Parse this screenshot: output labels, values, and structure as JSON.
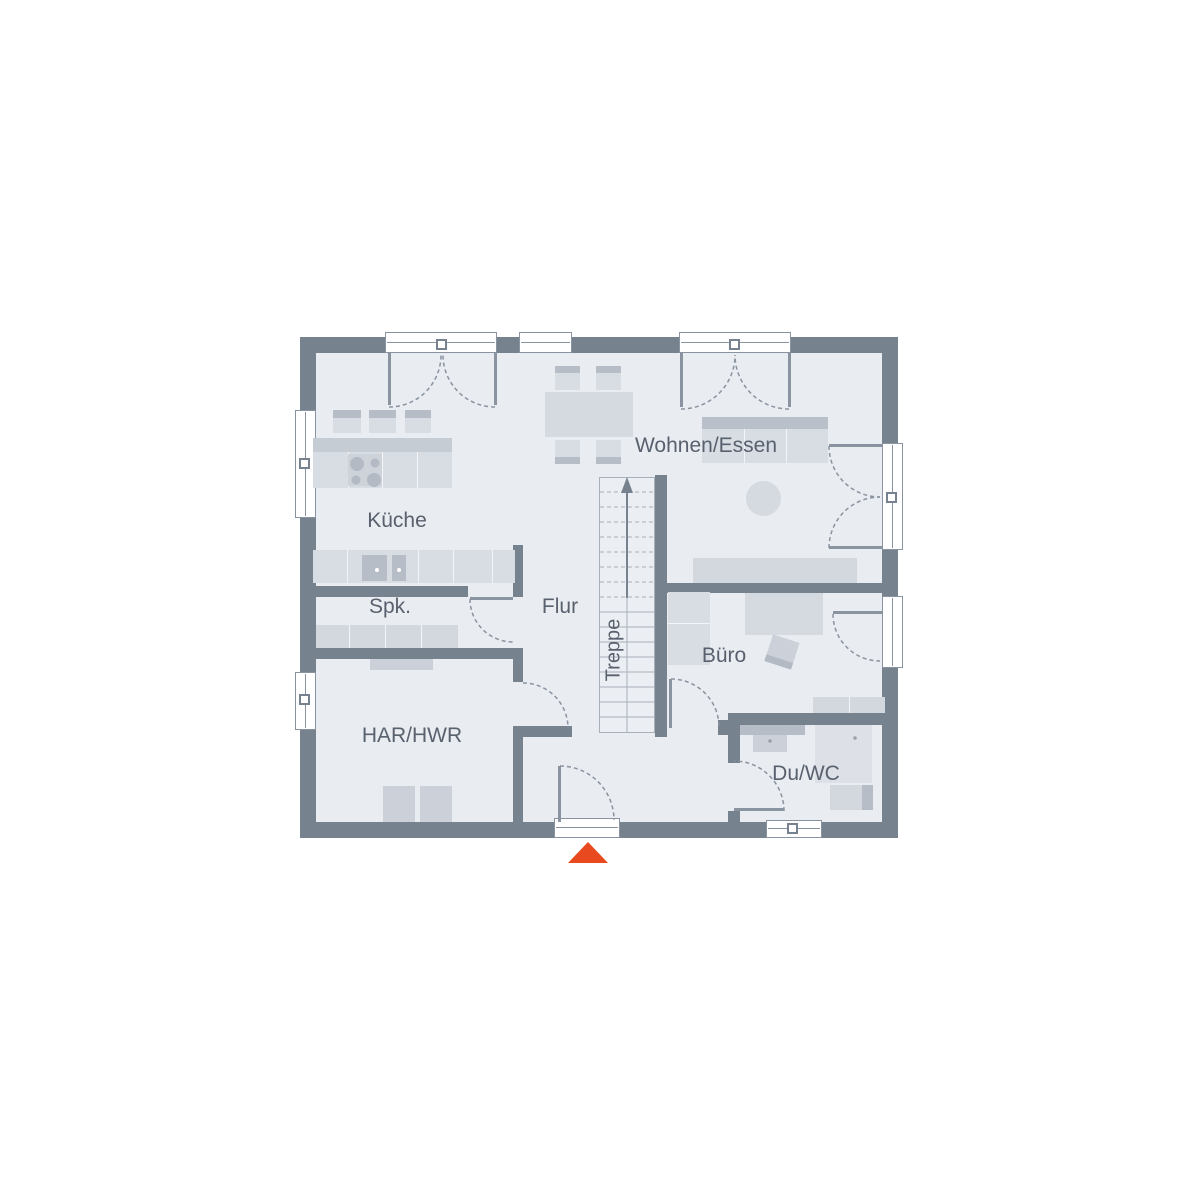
{
  "plan": {
    "rooms": {
      "kueche": "Küche",
      "spk": "Spk.",
      "flur": "Flur",
      "har_hwr": "HAR/HWR",
      "treppe": "Treppe",
      "wohnen_essen": "Wohnen/Essen",
      "buero": "Büro",
      "du_wc": "Du/WC"
    },
    "colors": {
      "wall": "#77828f",
      "floor": "#e9ecf1",
      "furniture_light": "#d8dce3",
      "furniture_dark": "#b6bdc7",
      "window_frame": "#ffffff",
      "swing_line": "#8a93a0",
      "label_text": "#59616e",
      "entrance_marker": "#e8491f"
    },
    "icons": {
      "stair_direction": "arrow-up-icon",
      "entrance": "entrance-triangle-icon"
    }
  }
}
